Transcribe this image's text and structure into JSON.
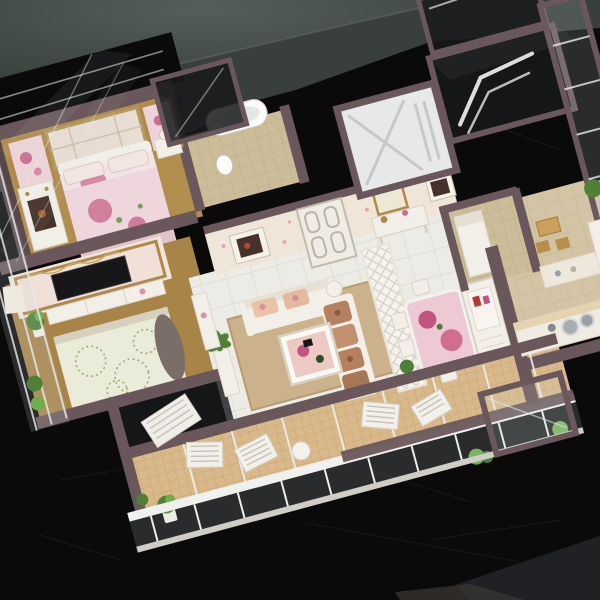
{
  "scene": {
    "type": "photograph",
    "subject": "miniature architectural scale model of an apartment floor plan, viewed from above at an angle, standing on a black table against a dark green backdrop",
    "rooms": [
      "master-bedroom",
      "second-bedroom",
      "bathroom",
      "entry-hall",
      "living-room",
      "dining-area",
      "kitchen",
      "small-bedroom",
      "breakfast-nook",
      "long-balcony",
      "west-balcony",
      "elevator-core",
      "stair-shaft"
    ],
    "objects": [
      "floral-double-bed",
      "headboard-art-panels",
      "dresser",
      "nightstand-lamp",
      "tv-wall",
      "flat-tv",
      "tv-cabinet",
      "green-quilt-bed",
      "potted-plant",
      "bathtub",
      "toilet",
      "entry-door",
      "wall-picture",
      "console-table",
      "loveseat-sofa",
      "long-sofa-with-cushions",
      "coffee-table",
      "floor-lamp",
      "palm-plant",
      "lattice-screen",
      "dining-table-floral",
      "dining-chairs",
      "display-hutch",
      "kitchen-counter",
      "sink-pots",
      "wooden-chairs",
      "lounge-chairs",
      "round-patio-table",
      "balcony-planters",
      "glass-walls",
      "elevator-roof-panel",
      "stair-handrail"
    ],
    "materials": {
      "walls": "dark maroon painted acrylic frames",
      "windows": "clear acrylic glass sheets",
      "floors": "printed tile, carpet and mosaic papers"
    }
  },
  "palette": {
    "table": "#0a0a0b",
    "backdrop_light": "#4d5651",
    "backdrop_dark": "#39403c",
    "wall": "#6a575b",
    "wall_dark": "#57464a",
    "floor_tile": "#edebe5",
    "tile_line": "#dbd8d1",
    "carpet": "#b28e4e",
    "carpet2": "#a98449",
    "bath_floor": "#ccbc9a",
    "balcony_tile": "#d9b98b",
    "balcony_line": "#c2a06d",
    "glass": "#cdd8dc",
    "dark_glass": "#17191b",
    "white_furn": "#f2efe8",
    "cream_wall": "#efe5d8",
    "gold": "#b0894a",
    "rose": "#cc6e92",
    "rose_deep": "#c25580",
    "quilt_pink": "#eed6dc",
    "quilt_green": "#eaecd9",
    "sofa_brown": "#b5805f",
    "rug": "#c9ae87",
    "tv": "#17171a",
    "plant": "#4e8036",
    "plant_light": "#6fae4a",
    "kitchen_floor": "#d2c4a4",
    "elevator_panel": "#e7e8e9",
    "door_white": "#f0ece4",
    "handrail": "#dedede",
    "art_dark": "#46322a"
  }
}
